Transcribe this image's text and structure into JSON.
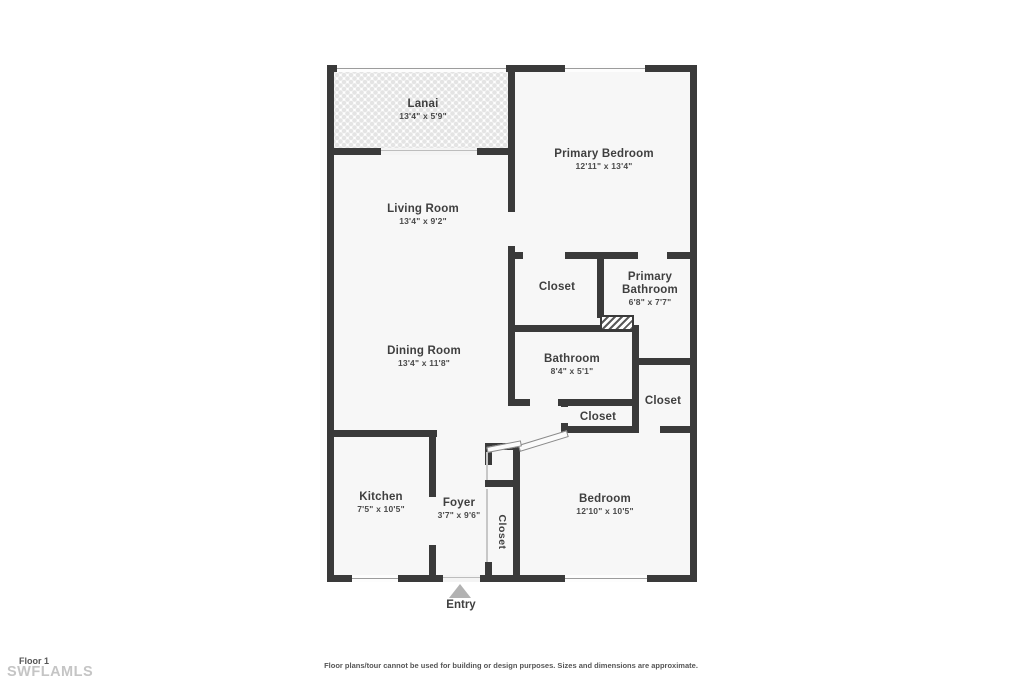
{
  "rooms": {
    "lanai": {
      "name": "Lanai",
      "dims": "13'4\" x 5'9\""
    },
    "living": {
      "name": "Living Room",
      "dims": "13'4\" x 9'2\""
    },
    "primary_bedroom": {
      "name": "Primary Bedroom",
      "dims": "12'11\" x 13'4\""
    },
    "closet_hall": {
      "name": "Closet"
    },
    "primary_bathroom": {
      "name": "Primary Bathroom",
      "dims": "6'8\" x 7'7\""
    },
    "dining": {
      "name": "Dining Room",
      "dims": "13'4\" x 11'8\""
    },
    "bathroom": {
      "name": "Bathroom",
      "dims": "8'4\" x 5'1\""
    },
    "closet_small": {
      "name": "Closet"
    },
    "closet_right": {
      "name": "Closet"
    },
    "kitchen": {
      "name": "Kitchen",
      "dims": "7'5\" x 10'5\""
    },
    "foyer": {
      "name": "Foyer",
      "dims": "3'7\" x 9'6\""
    },
    "closet_foyer": {
      "name": "Closet"
    },
    "bedroom": {
      "name": "Bedroom",
      "dims": "12'10\" x 10'5\""
    }
  },
  "entry": {
    "label": "Entry"
  },
  "footer": {
    "floor": "Floor 1",
    "watermark": "SWFLAMLS",
    "disclaimer": "Floor plans/tour cannot be used for building or design purposes. Sizes and dimensions are approximate."
  },
  "colors": {
    "wall": "#3a3a3a",
    "room_fill": "#f7f7f7",
    "entry_arrow": "#b2b2b2",
    "watermark_text": "#c5c5c5",
    "label_text": "#3f3f3f"
  }
}
